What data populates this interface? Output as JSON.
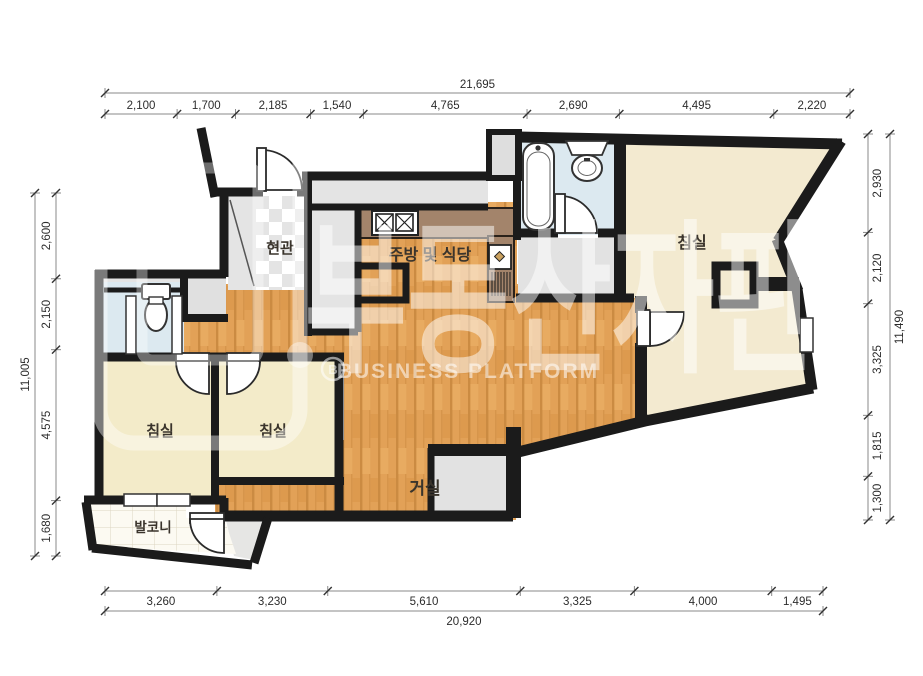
{
  "rooms": {
    "entrance": "현관",
    "kitchen": "주방 및 식당",
    "bedroom_main": "침실",
    "bedroom_left": "침실",
    "bedroom_middle": "침실",
    "living": "거실",
    "balcony": "발코니"
  },
  "watermark": {
    "korean": "부동산자판기",
    "english": "BUSINESS PLATFORM",
    "logo_letter": "B"
  },
  "dimensions": {
    "top": {
      "total": "21,695",
      "labels": [
        "2,100",
        "1,700",
        "2,185",
        "1,540",
        "4,765",
        "2,690",
        "4,495",
        "2,220"
      ],
      "values": [
        2100,
        1700,
        2185,
        1540,
        4765,
        2690,
        4495,
        2220
      ]
    },
    "bottom": {
      "total": "20,920",
      "labels": [
        "3,260",
        "3,230",
        "5,610",
        "3,325",
        "4,000",
        "1,495"
      ],
      "values": [
        3260,
        3230,
        5610,
        3325,
        4000,
        1495
      ]
    },
    "left": {
      "total": "11,005",
      "labels": [
        "2,600",
        "2,150",
        "4,575",
        "1,680"
      ],
      "values": [
        2600,
        2150,
        4575,
        1680
      ]
    },
    "right": {
      "total": "11,490",
      "labels": [
        "2,930",
        "2,120",
        "3,325",
        "1,815",
        "1,300"
      ],
      "values": [
        2930,
        2120,
        3325,
        1815,
        1300
      ]
    }
  },
  "colors": {
    "wall": "#1b1b1b",
    "wood_floor": "#e2a157",
    "bedroom_fill": "#f3ebc9",
    "bathroom_fill": "#dce9f0",
    "counter_fill": "#a3846b",
    "utility_gray": "#e4e4e4",
    "balcony_fill": "#fcfaf2",
    "dimension_text": "#2c2c2c"
  }
}
